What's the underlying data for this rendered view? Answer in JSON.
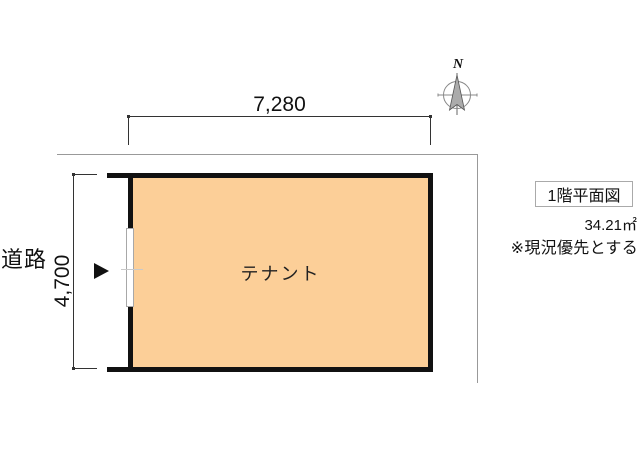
{
  "plan": {
    "room_label": "テナント",
    "road_label": "道路",
    "width_dimension": "7,280",
    "height_dimension": "4,700",
    "compass_label": "N"
  },
  "info": {
    "title": "1階平面図",
    "area": "34.21㎡",
    "note": "※現況優先とする"
  },
  "colors": {
    "room_fill": "#FCCF98",
    "wall": "#111111",
    "boundary": "#999999",
    "dimension": "#333333",
    "needle_fill": "#ABABAB",
    "needle_stroke": "#555555",
    "compass_ring": "#888888"
  }
}
